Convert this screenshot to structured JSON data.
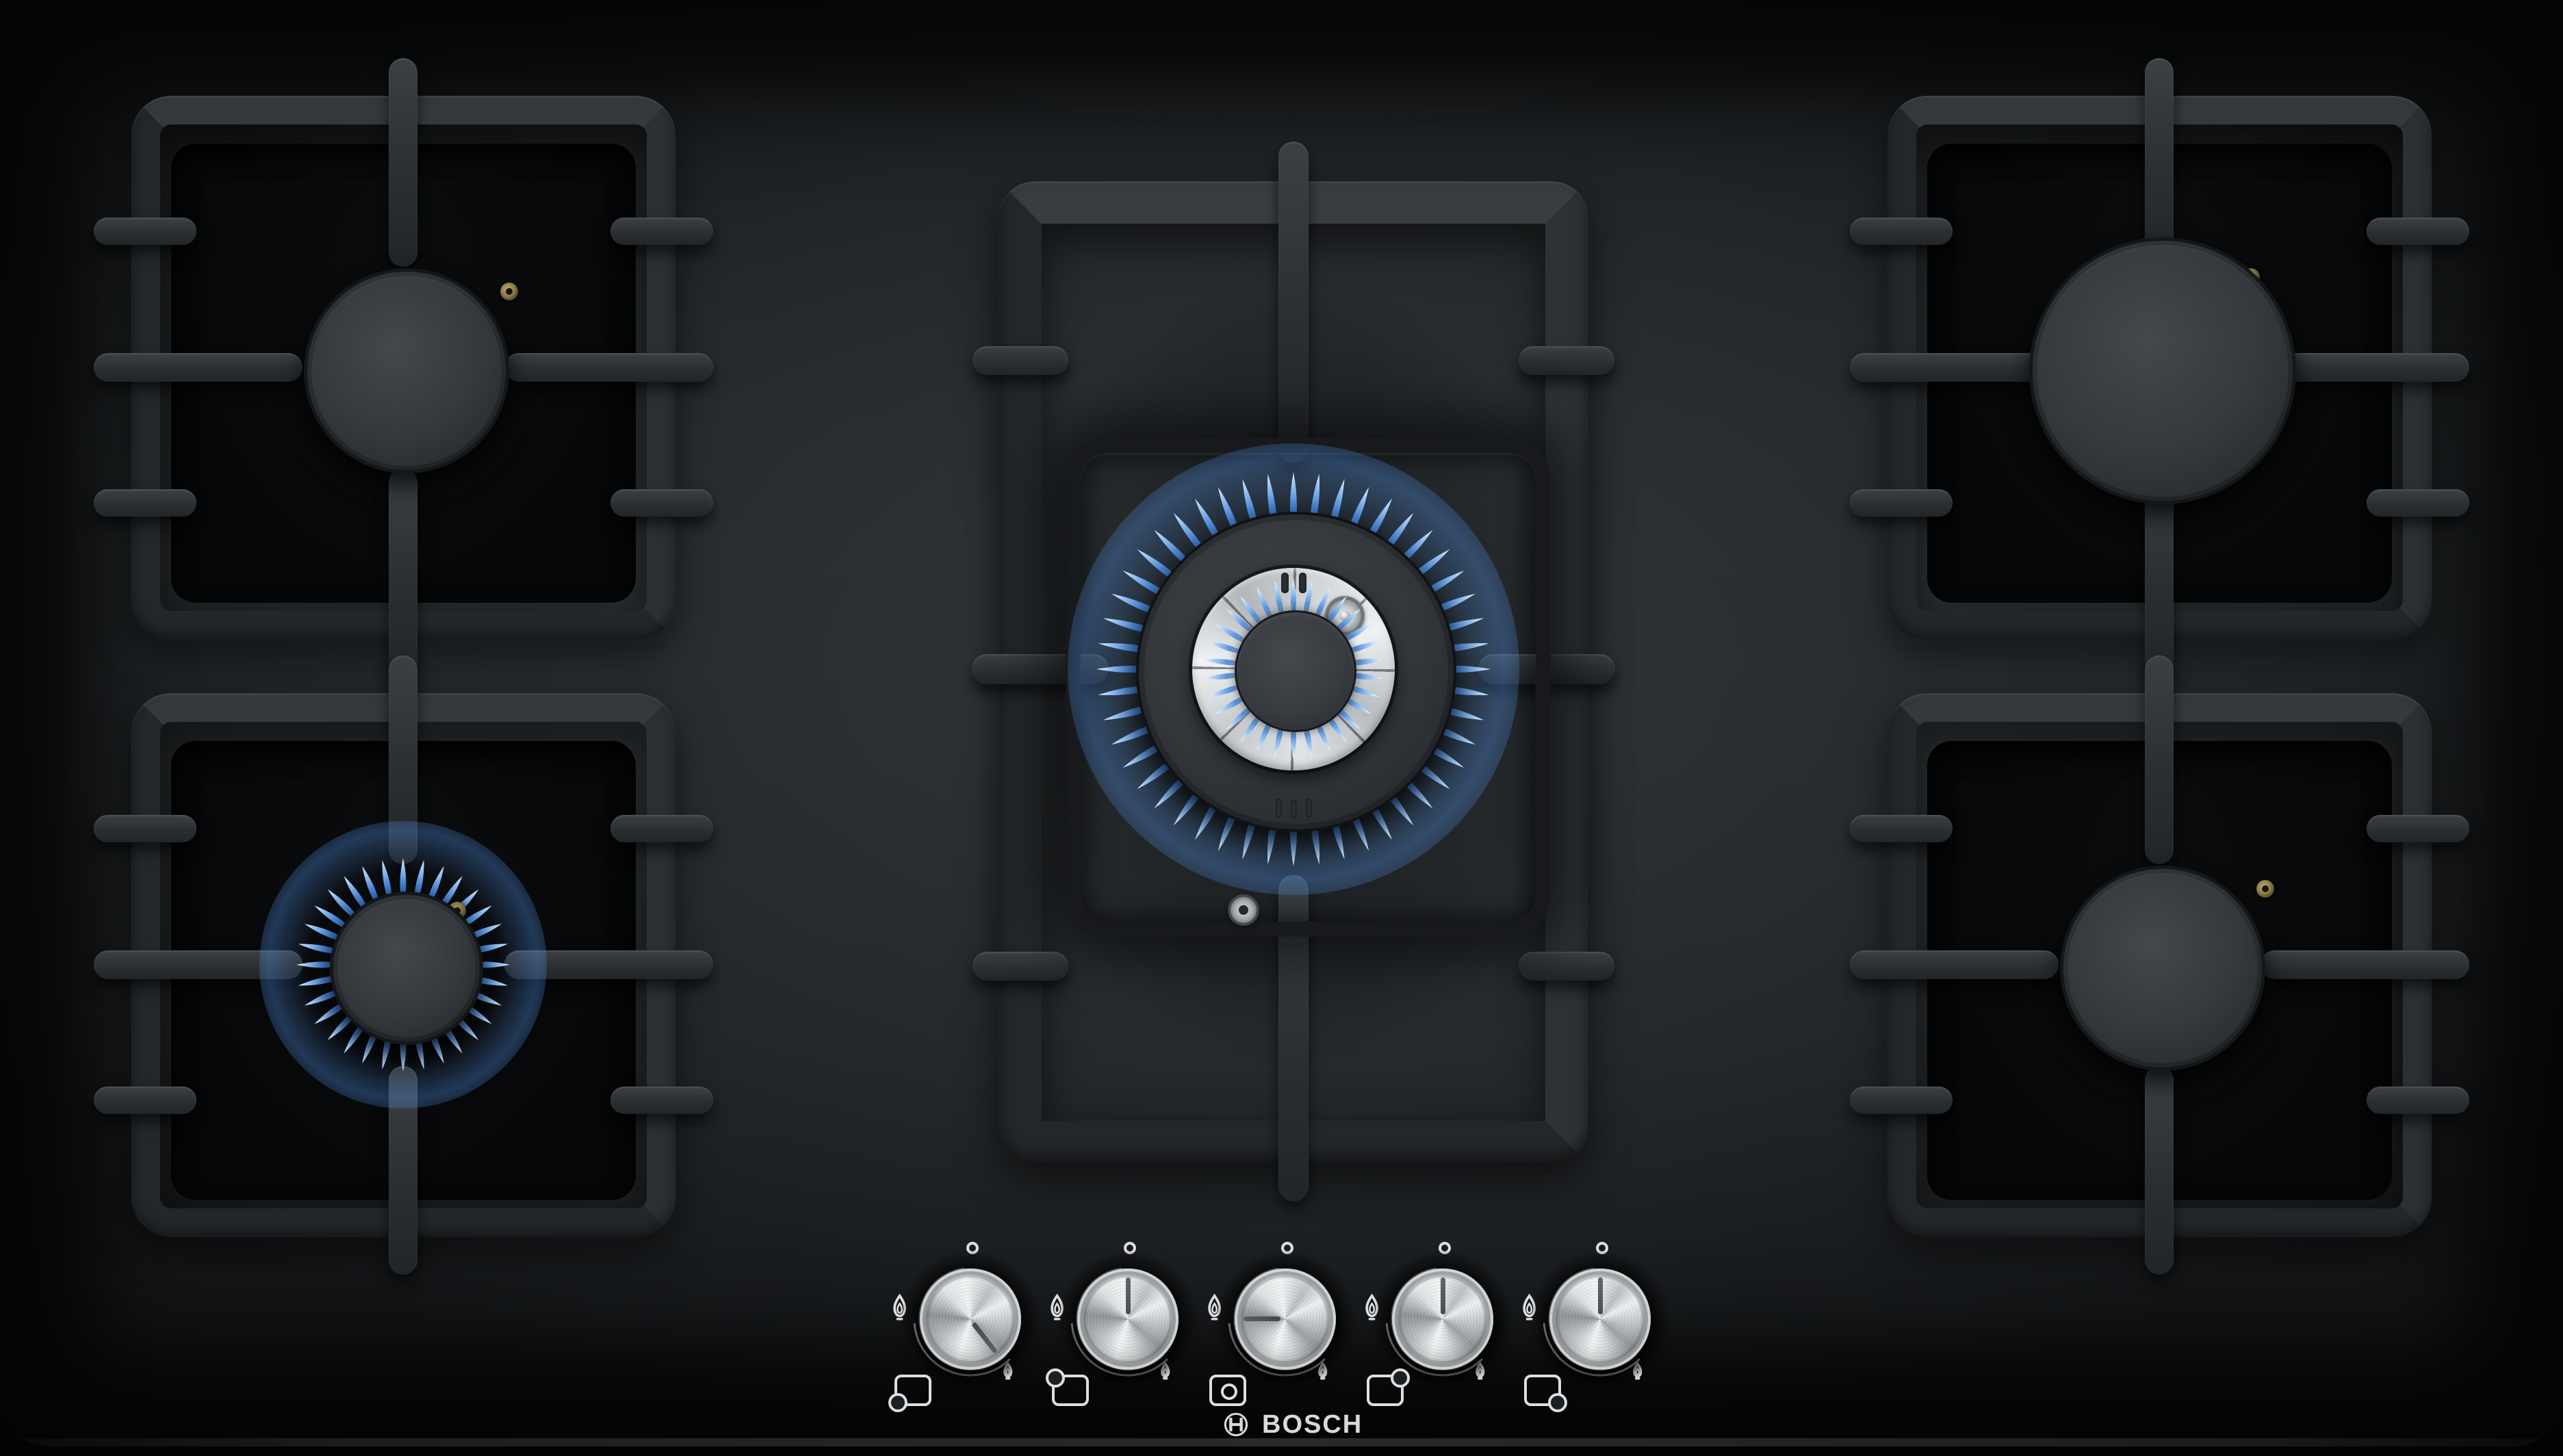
{
  "meta": {
    "product": "Bosch 5-burner gas hob, black tempered glass",
    "view": "top-down product photo"
  },
  "brand": {
    "name": "BOSCH",
    "emblem": "bosch-armature-icon"
  },
  "burners": {
    "back_left": {
      "label": "back left burner",
      "size": "standard",
      "state": "off"
    },
    "front_left": {
      "label": "front left burner",
      "size": "standard",
      "state": "simmer",
      "flame": "small blue flame ring"
    },
    "center": {
      "label": "center wok burner",
      "size": "wok",
      "state": "high",
      "flame": "full blue flame ring with inner crown"
    },
    "back_right": {
      "label": "back right burner",
      "size": "large",
      "state": "off"
    },
    "front_right": {
      "label": "front right burner",
      "size": "standard",
      "state": "off"
    }
  },
  "knobs": [
    {
      "id": "front-left",
      "burner": "front left",
      "setting": "simmer",
      "pointer_angle_deg": 142,
      "position_icon": "pan-front-left"
    },
    {
      "id": "back-left",
      "burner": "back left",
      "setting": "off",
      "pointer_angle_deg": 0,
      "position_icon": "pan-back-left"
    },
    {
      "id": "center",
      "burner": "center wok",
      "setting": "high",
      "pointer_angle_deg": -90,
      "position_icon": "pan-center"
    },
    {
      "id": "back-right",
      "burner": "back right",
      "setting": "off",
      "pointer_angle_deg": 0,
      "position_icon": "pan-back-right"
    },
    {
      "id": "front-right",
      "burner": "front right",
      "setting": "off",
      "pointer_angle_deg": 0,
      "position_icon": "pan-front-right"
    }
  ],
  "knob_scale": {
    "off_marker": "small circle at 12 o'clock",
    "high_marker": "large-flame-icon",
    "low_marker": "small-flame-icon"
  },
  "colors": {
    "glass": "#17191b",
    "glass_highlight": "#31363a",
    "grate": "#2e3236",
    "burner_cap": "#34393d",
    "flame_blue": "#4f8cd9",
    "flame_tip": "#e3f2ff",
    "knob_metal": "#d9dcde",
    "markings_white": "#dcdee0",
    "logo_white": "#d7d9da",
    "igniter_brass": "#a4905c"
  }
}
